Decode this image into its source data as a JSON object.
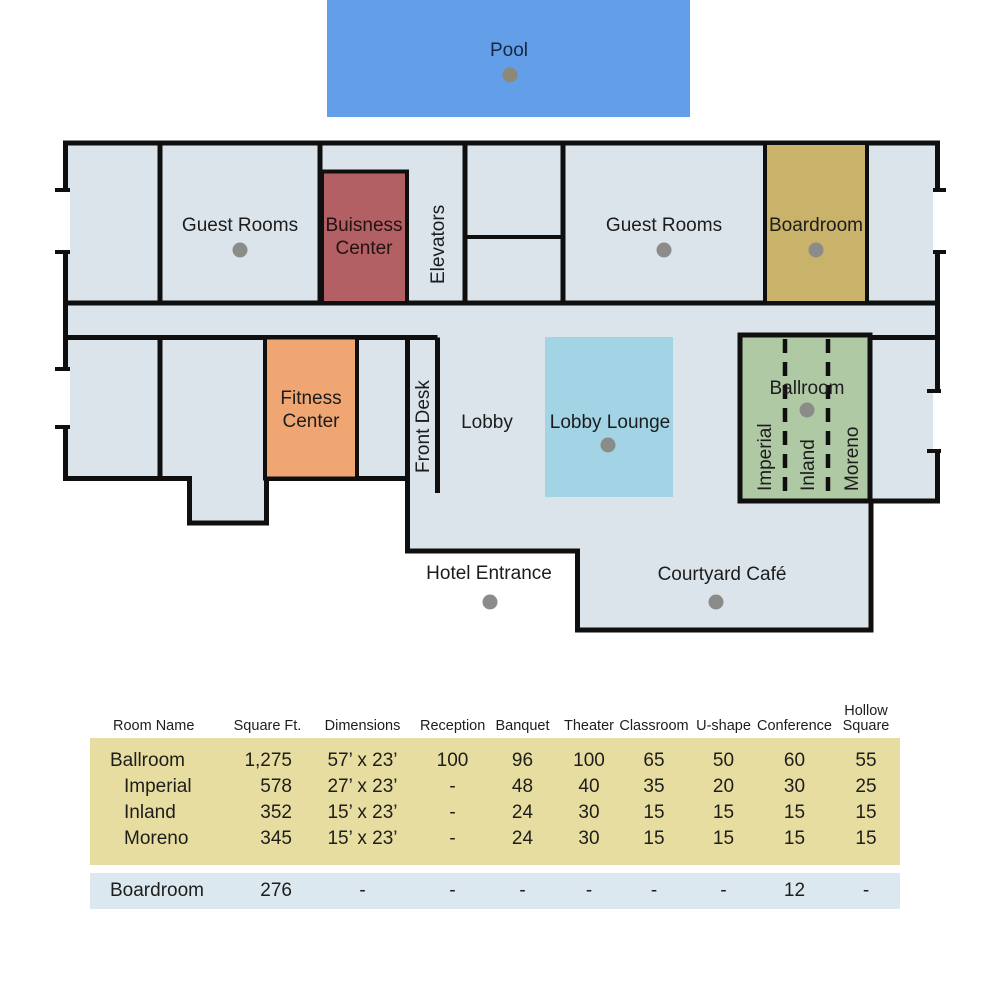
{
  "floorplan": {
    "pool_label": "Pool",
    "guest_rooms_left_label": "Guest Rooms",
    "business_center_label": {
      "line1": "Buisness",
      "line2": "Center"
    },
    "elevators_label": "Elevators",
    "guest_rooms_right_label": "Guest Rooms",
    "boardroom_label": "Boardroom",
    "fitness_center_label": {
      "line1": "Fitness",
      "line2": "Center"
    },
    "front_desk_label": "Front Desk",
    "lobby_label": "Lobby",
    "lobby_lounge_label": "Lobby Lounge",
    "ballroom_label": "Ballroom",
    "ballroom_sections": {
      "imperial": "Imperial",
      "inland": "Inland",
      "moreno": "Moreno"
    },
    "hotel_entrance_label": "Hotel Entrance",
    "courtyard_cafe_label": "Courtyard Café"
  },
  "colors": {
    "pool": "#629fe8",
    "floor": "#dbe4eb",
    "wall": "#0f0f0f",
    "business_center": "#b26063",
    "boardroom": "#c9b269",
    "fitness_center": "#efa673",
    "lobby_lounge": "#a2d4e6",
    "ballroom": "#b0c9a5",
    "marker_dot": "#8b8b89",
    "table_meeting_rooms_bg": "#e7dda0",
    "table_boardroom_bg": "#dce8f0"
  },
  "table": {
    "headers": [
      "Room Name",
      "Square Ft.",
      "Dimensions",
      "Reception",
      "Banquet",
      "Theater",
      "Classroom",
      "U-shape",
      "Conference",
      "Hollow Square"
    ],
    "rows": [
      {
        "cells": [
          "Ballroom",
          "1,275",
          "57’ x 23’",
          "100",
          "96",
          "100",
          "65",
          "50",
          "60",
          "55"
        ]
      },
      {
        "cells": [
          "Imperial",
          "578",
          "27’ x 23’",
          "-",
          "48",
          "40",
          "35",
          "20",
          "30",
          "25"
        ]
      },
      {
        "cells": [
          "Inland",
          "352",
          "15’ x 23’",
          "-",
          "24",
          "30",
          "15",
          "15",
          "15",
          "15"
        ]
      },
      {
        "cells": [
          "Moreno",
          "345",
          "15’ x 23’",
          "-",
          "24",
          "30",
          "15",
          "15",
          "15",
          "15"
        ]
      },
      {
        "cells": [
          "Boardroom",
          "276",
          "-",
          "-",
          "-",
          "-",
          "-",
          "-",
          "12",
          "-"
        ]
      }
    ]
  }
}
